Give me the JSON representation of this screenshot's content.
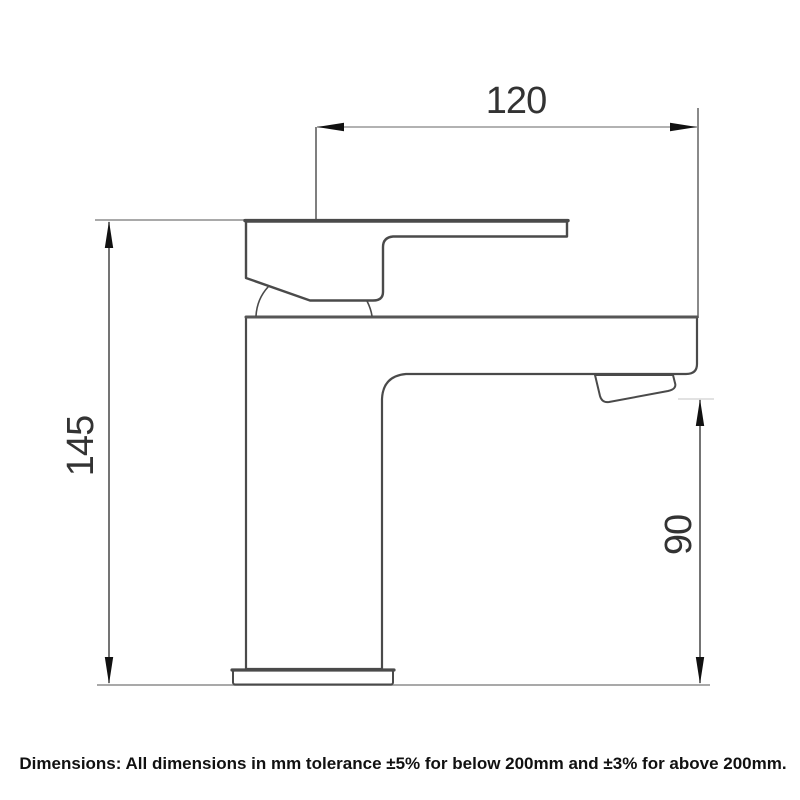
{
  "drawing": {
    "dimensions": {
      "width": {
        "value": "120",
        "unit": "mm",
        "orientation": "horizontal",
        "measures": "spout reach from handle front to spout tip"
      },
      "height": {
        "value": "145",
        "unit": "mm",
        "orientation": "vertical",
        "measures": "overall tap height from base to top of handle"
      },
      "spout_height": {
        "value": "90",
        "unit": "mm",
        "orientation": "vertical",
        "measures": "height from base to underside of spout outlet"
      }
    },
    "note": "Dimensions: All dimensions in mm tolerance ±5% for below 200mm and ±3% for above 200mm.",
    "colors": {
      "outline": "#4a4a4a",
      "dimension_line": "#989898",
      "dimension_stem": "#2a2a2a",
      "extension_line": "#a9a9a9",
      "faint_extension_line": "#d9d9d9",
      "arrow": "#111111",
      "dimension_text": "#333333",
      "note_text": "#111111",
      "background": "#ffffff"
    }
  }
}
